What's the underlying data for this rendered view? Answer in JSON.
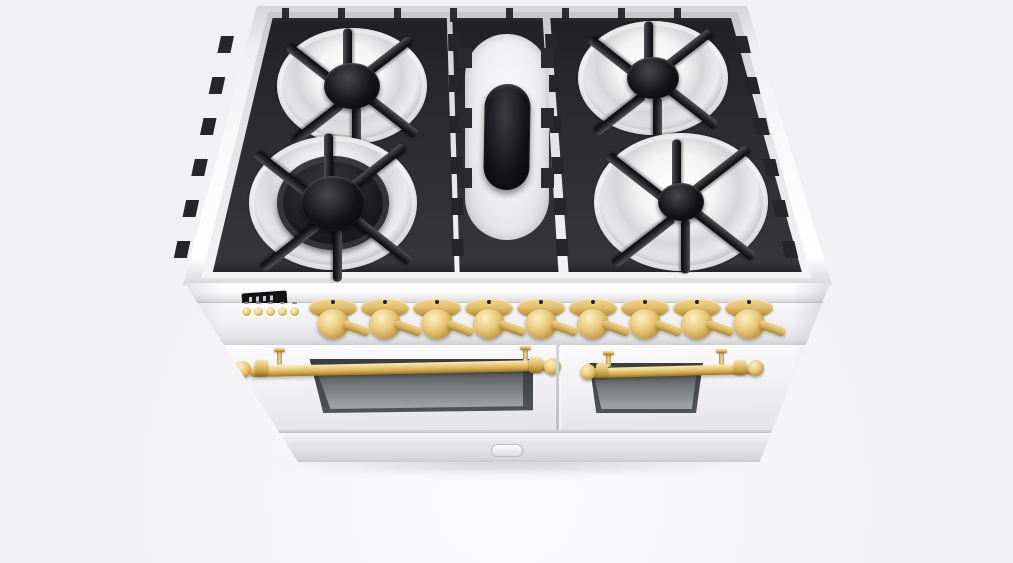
{
  "scene": {
    "description": "3D product render of a white freestanding double-oven range cooker with a black gas cooktop grate and brass hardware, viewed from the front at a high angle on a plain light-gray background",
    "background_color": "#f1f1f4"
  },
  "colors": {
    "body_white": "#f6f6f8",
    "deck_gray": "#e4e4e7",
    "grate_black": "#2b2b2e",
    "burner_cap_black": "#0e0e10",
    "brass": "#e6c87c",
    "brass_dark": "#9c7a2c",
    "oven_window_gray": "#74777a"
  },
  "cooktop": {
    "grate_sections": 3,
    "burners": [
      {
        "name": "rear-left-burner",
        "type": "round-sealed-burner"
      },
      {
        "name": "front-left-burner",
        "type": "round-dual-ring-burner"
      },
      {
        "name": "center-oval-burner",
        "type": "oval-griddle-burner"
      },
      {
        "name": "rear-right-burner",
        "type": "round-sealed-burner"
      },
      {
        "name": "front-right-burner",
        "type": "round-sealed-burner"
      }
    ]
  },
  "control_panel": {
    "clock_display": {
      "value": "",
      "type": "digital-clock"
    },
    "button_count": 5,
    "knob_count": 9
  },
  "doors": {
    "left_oven": {
      "handle": "brass-rail-handle",
      "window": true
    },
    "right_oven": {
      "handle": "brass-rail-handle",
      "window": true
    }
  },
  "drawer": {
    "latch": true
  }
}
